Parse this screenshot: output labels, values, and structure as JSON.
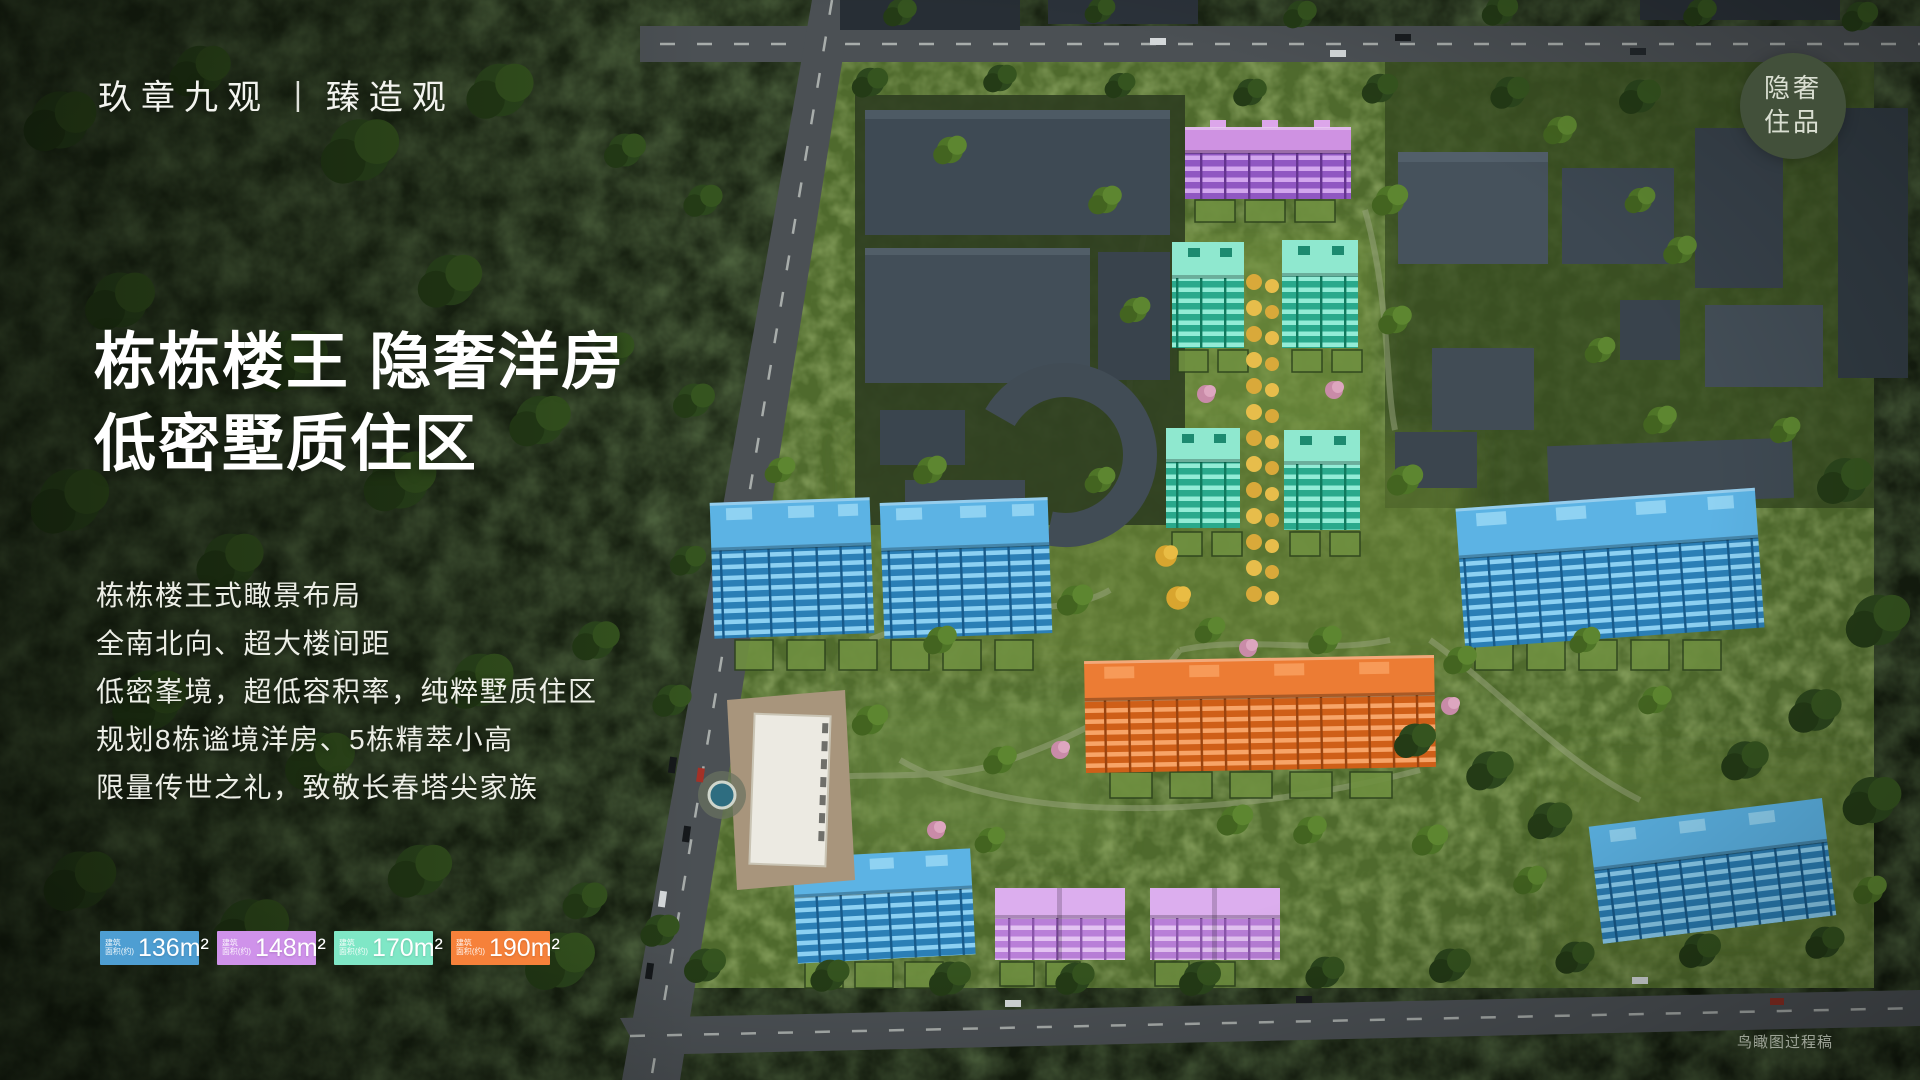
{
  "brand": {
    "name_left": "玖章九观",
    "divider": "|",
    "name_right": "臻造观"
  },
  "corner_badge": {
    "line1": "隐奢",
    "line2": "住品",
    "bg_color": "#42503a"
  },
  "headline": {
    "line1": "栋栋楼王 隐奢洋房",
    "line2": "低密墅质住区"
  },
  "body_copy": {
    "lines": [
      "栋栋楼王式瞰景布局",
      "全南北向、超大楼间距",
      "低密峯境，超低容积率，纯粹墅质住区",
      "规划8栋谧境洋房、5栋精萃小高",
      "限量传世之礼，致敬长春塔尖家族"
    ]
  },
  "legend": {
    "label_line1": "建筑",
    "label_line2": "面积(约)",
    "items": [
      {
        "area": "136m²",
        "color": "#4e9ed2",
        "building_color_name": "blue"
      },
      {
        "area": "148m²",
        "color": "#cf92ea",
        "building_color_name": "purple"
      },
      {
        "area": "170m²",
        "color": "#7fe7c6",
        "building_color_name": "teal"
      },
      {
        "area": "190m²",
        "color": "#f6813a",
        "building_color_name": "orange"
      }
    ]
  },
  "watermark": "鸟瞰图过程稿",
  "palette": {
    "building_blue": "#3d9ad2",
    "building_teal": "#3cbb9e",
    "building_purple": "#b678dd",
    "building_orange": "#e8722a",
    "badge_green": "#42503a",
    "golden_alley": "#d9a93a"
  }
}
